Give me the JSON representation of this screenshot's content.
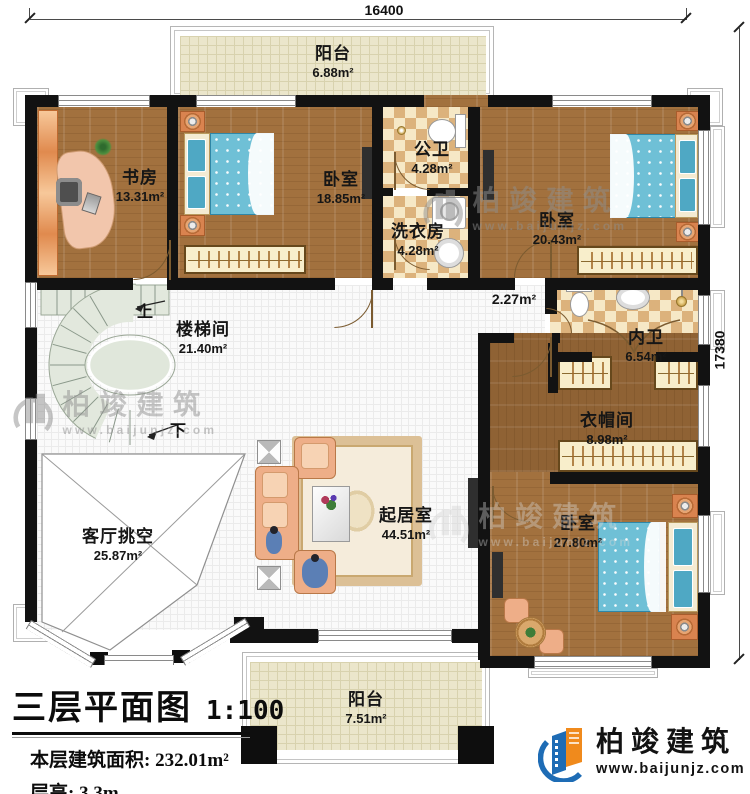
{
  "title_block": {
    "title": "三层平面图",
    "scale": "1:100",
    "area_label": "本层建筑面积:",
    "area_value": "232.01m²",
    "height_label": "层高:",
    "height_value": "3.3m"
  },
  "dimensions": {
    "width": "16400",
    "height": "17380"
  },
  "stairs": {
    "up": "上",
    "down": "下"
  },
  "rooms": {
    "balcony_top": {
      "name": "阳台",
      "area": "6.88m²"
    },
    "study": {
      "name": "书房",
      "area": "13.31m²"
    },
    "bedroom_top": {
      "name": "卧室",
      "area": "18.85m²"
    },
    "public_bath": {
      "name": "公卫",
      "area": "4.28m²"
    },
    "laundry": {
      "name": "洗衣房",
      "area": "4.28m²"
    },
    "bedroom_right": {
      "name": "卧室",
      "area": "20.43m²"
    },
    "corridor": {
      "area": "2.27m²"
    },
    "stairwell": {
      "name": "楼梯间",
      "area": "21.40m²"
    },
    "ensuite_bath": {
      "name": "内卫",
      "area": "6.54m²"
    },
    "cloakroom": {
      "name": "衣帽间",
      "area": "8.98m²"
    },
    "living_void": {
      "name": "客厅挑空",
      "area": "25.87m²"
    },
    "living_room": {
      "name": "起居室",
      "area": "44.51m²"
    },
    "bedroom_master": {
      "name": "卧室",
      "area": "27.80m²"
    },
    "balcony_bottom": {
      "name": "阳台",
      "area": "7.51m²"
    }
  },
  "branding": {
    "brand": "柏竣建筑",
    "website": "www.baijunjz.com"
  },
  "watermark": {
    "brand": "柏竣建筑",
    "website": "www.baijunjz.com"
  },
  "colors": {
    "wall": "#121212",
    "wood_floor": "#a2713e",
    "bath_tile": "#dcb27c",
    "balcony_tile": "#ebe6cb",
    "stair_floor": "#e2e8dd",
    "bed_blue": "#6fc0d6",
    "sofa_salmon": "#eeae88",
    "logo_blue": "#1e6cb5",
    "logo_orange": "#f08a1c"
  }
}
